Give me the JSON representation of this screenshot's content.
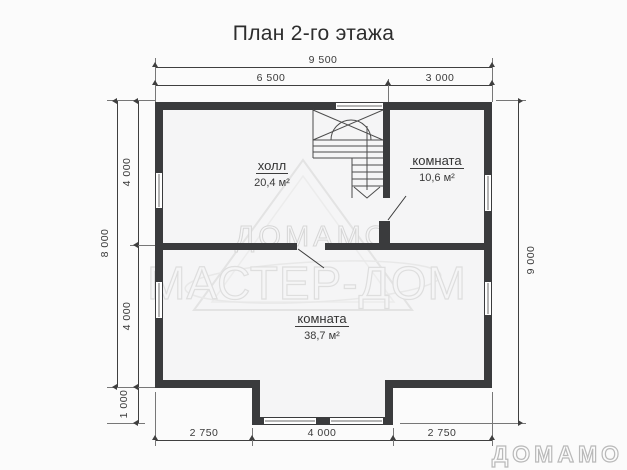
{
  "title": "План 2-го этажа",
  "rooms": [
    {
      "name": "холл",
      "area": "20,4 м²"
    },
    {
      "name": "комната",
      "area": "10,6 м²"
    },
    {
      "name": "комната",
      "area": "38,7 м²"
    }
  ],
  "dimensions": {
    "top_total": "9 500",
    "top_segment_left": "6 500",
    "top_segment_right": "3 000",
    "left_total": "8 000",
    "left_segment_upper": "4 000",
    "left_segment_lower": "4 000",
    "left_segment_bay": "1 000",
    "right_total": "9 000",
    "bottom_segment_left": "2 750",
    "bottom_segment_middle": "4 000",
    "bottom_segment_right": "2 750"
  },
  "watermark": {
    "brand": "ДОМАМО",
    "subbrand": "МАСТЕР-ДОМ"
  },
  "logo_text": "ДОМАМО",
  "colors": {
    "wall": "#3a3b3d",
    "dimension": "#3f3f3f",
    "watermark_outline": "#d9d9d9",
    "logo_outline": "#b9b9b9"
  }
}
